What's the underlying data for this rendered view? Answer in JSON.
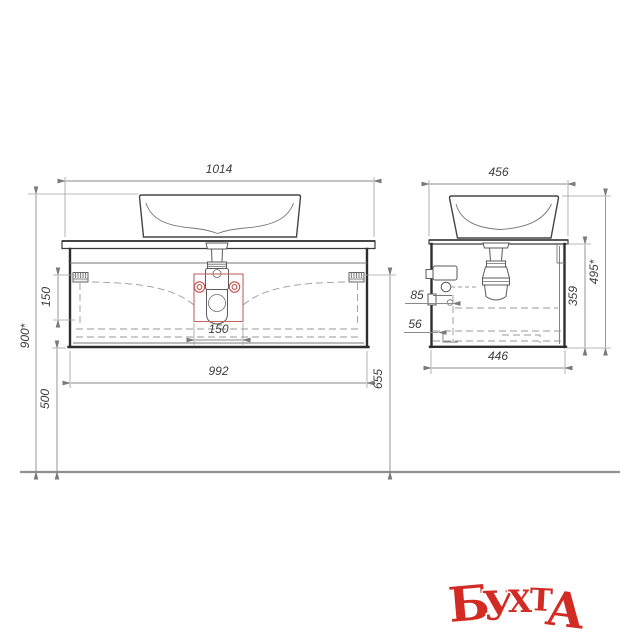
{
  "drawing": {
    "type": "bathroom-vanity-technical-drawing",
    "front_view": {
      "dim_top_width": "1014",
      "dim_bottom_width": "992",
      "dim_overall_height": "900*",
      "dim_hang_offset": "150",
      "dim_cutout_width": "150",
      "dim_floor_clearance": "500",
      "dim_bracket_to_floor": "655"
    },
    "side_view": {
      "dim_top_depth": "456",
      "dim_bottom_depth": "446",
      "dim_cabinet_height": "359",
      "dim_overall_height": "495*",
      "dim_back_upper": "85",
      "dim_back_lower": "56"
    }
  },
  "watermark": {
    "text": "БУХТА",
    "letters": [
      "Б",
      "У",
      "Х",
      "Т",
      "А"
    ],
    "color": "#d22b24"
  },
  "colors": {
    "background": "#ffffff",
    "object_line": "#4a4a4a",
    "carcass_line": "#2e2e2e",
    "dimension_line": "#8a8a8a",
    "accent_red": "#c4504c",
    "watermark_red": "#d22b24"
  }
}
